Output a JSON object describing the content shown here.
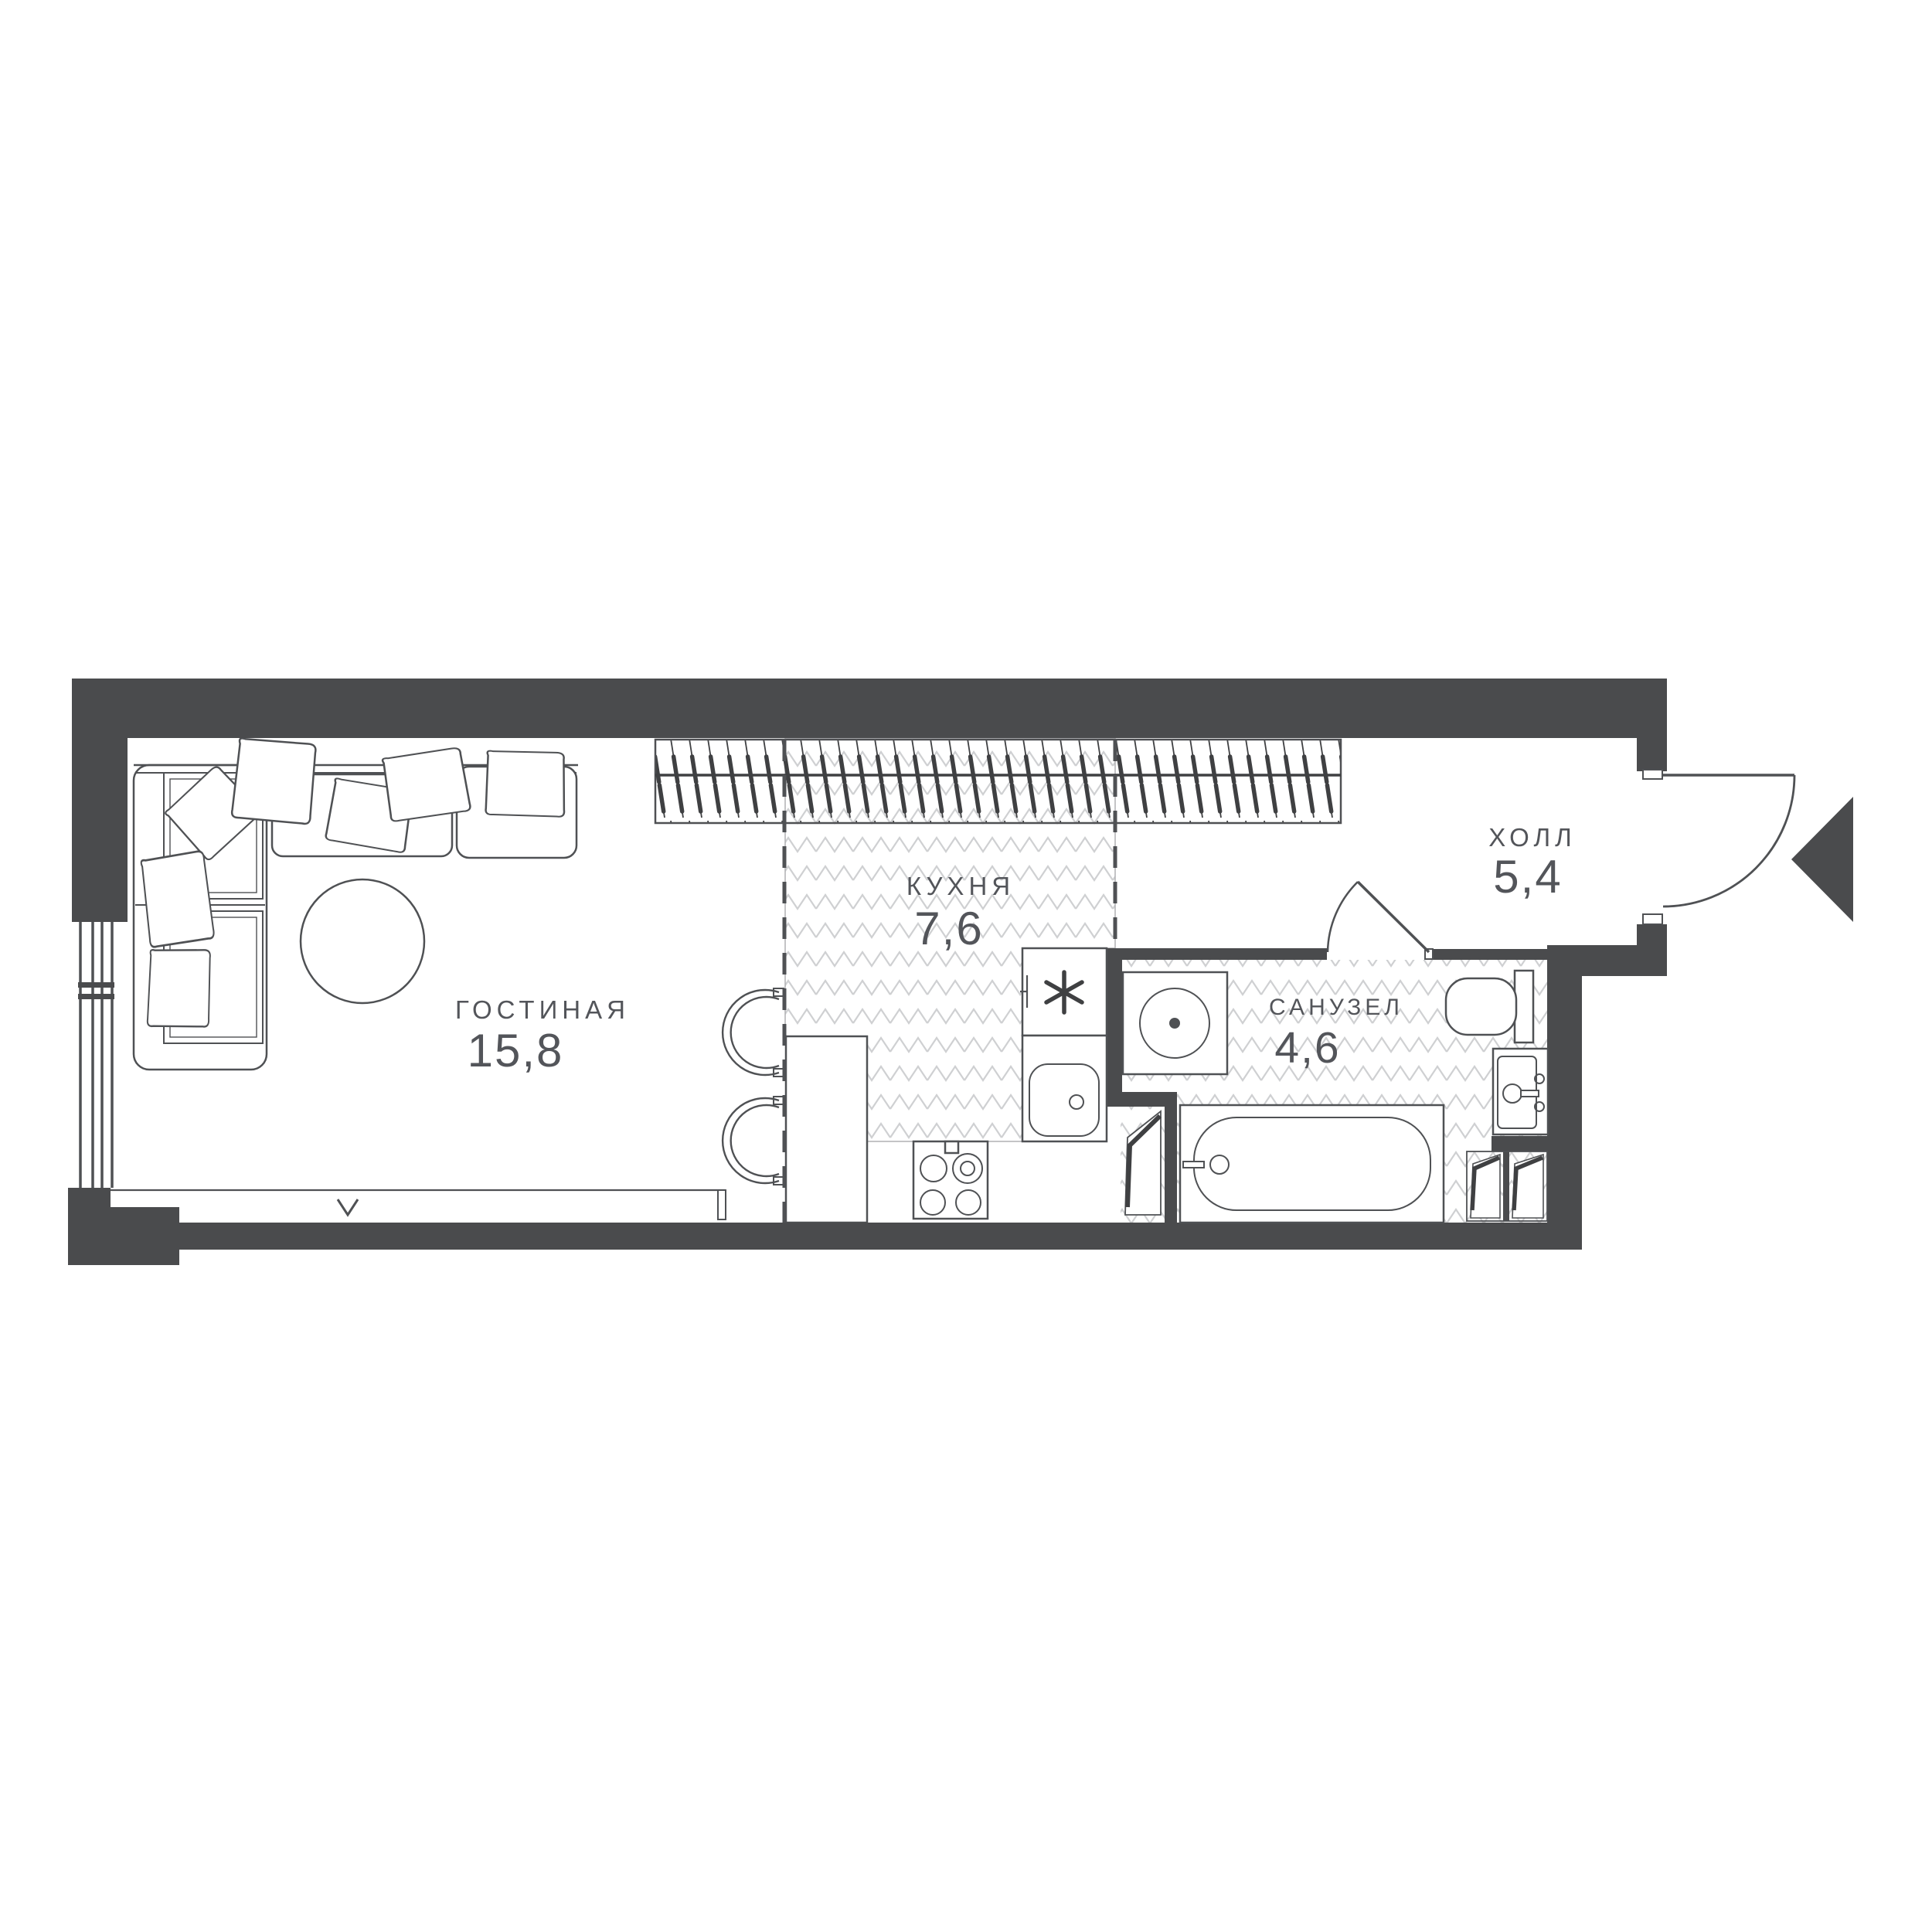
{
  "plan": {
    "title": "studio-apartment-floor-plan",
    "rooms": [
      {
        "id": "living",
        "name": "ГОСТИНАЯ",
        "area": "15,8"
      },
      {
        "id": "kitchen",
        "name": "КУХНЯ",
        "area": "7,6"
      },
      {
        "id": "bathroom",
        "name": "САНУЗЕЛ",
        "area": "4,6"
      },
      {
        "id": "hall",
        "name": "ХОЛЛ",
        "area": "5,4"
      }
    ],
    "colors": {
      "wall": "#4a4b4d",
      "line": "#4f5154",
      "pattern": "#cfd0d2",
      "text": "#53555a",
      "background": "#ffffff"
    },
    "icons": [
      "sofa-icon",
      "pillow-icon",
      "coffee-table-icon",
      "chair-icon",
      "kitchen-counter-icon",
      "oven-icon",
      "kitchen-sink-icon",
      "cooktop-icon",
      "washing-machine-icon",
      "bathtub-icon",
      "toilet-icon",
      "bathroom-sink-icon",
      "wardrobe-rail-icon",
      "entry-door-icon",
      "bathroom-door-icon",
      "entrance-arrow-icon",
      "window-icon",
      "vent-shaft-icon"
    ]
  }
}
